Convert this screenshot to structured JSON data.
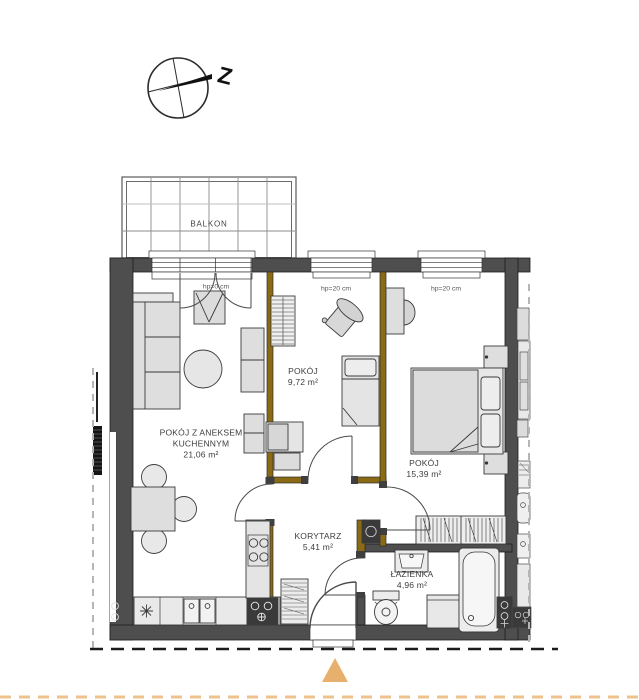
{
  "compass": {
    "label": "Z"
  },
  "balcony": {
    "label": "BALKON"
  },
  "rooms": [
    {
      "id": "living",
      "name": "POKÓJ Z ANEKSEM KUCHENNYM",
      "area": "21,06 m²"
    },
    {
      "id": "room-s",
      "name": "POKÓJ",
      "area": "9,72 m²"
    },
    {
      "id": "room-l",
      "name": "POKÓJ",
      "area": "15,39 m²"
    },
    {
      "id": "corridor",
      "name": "KORYTARZ",
      "area": "5,41 m²"
    },
    {
      "id": "bathroom",
      "name": "ŁAZIENKA",
      "area": "4,96 m²"
    }
  ],
  "window_labels": [
    "hp=0 cm",
    "hp=20 cm",
    "hp=20 cm"
  ],
  "colors": {
    "wall": "#4e4e4e",
    "partition": "#8a6a14",
    "furniture_fill": "#dedede",
    "accent_triangle": "#e7b16d",
    "accent_dash": "#eec28d",
    "boundary_dash": "#b5b5b5",
    "section_dash": "#1c1c1c"
  }
}
